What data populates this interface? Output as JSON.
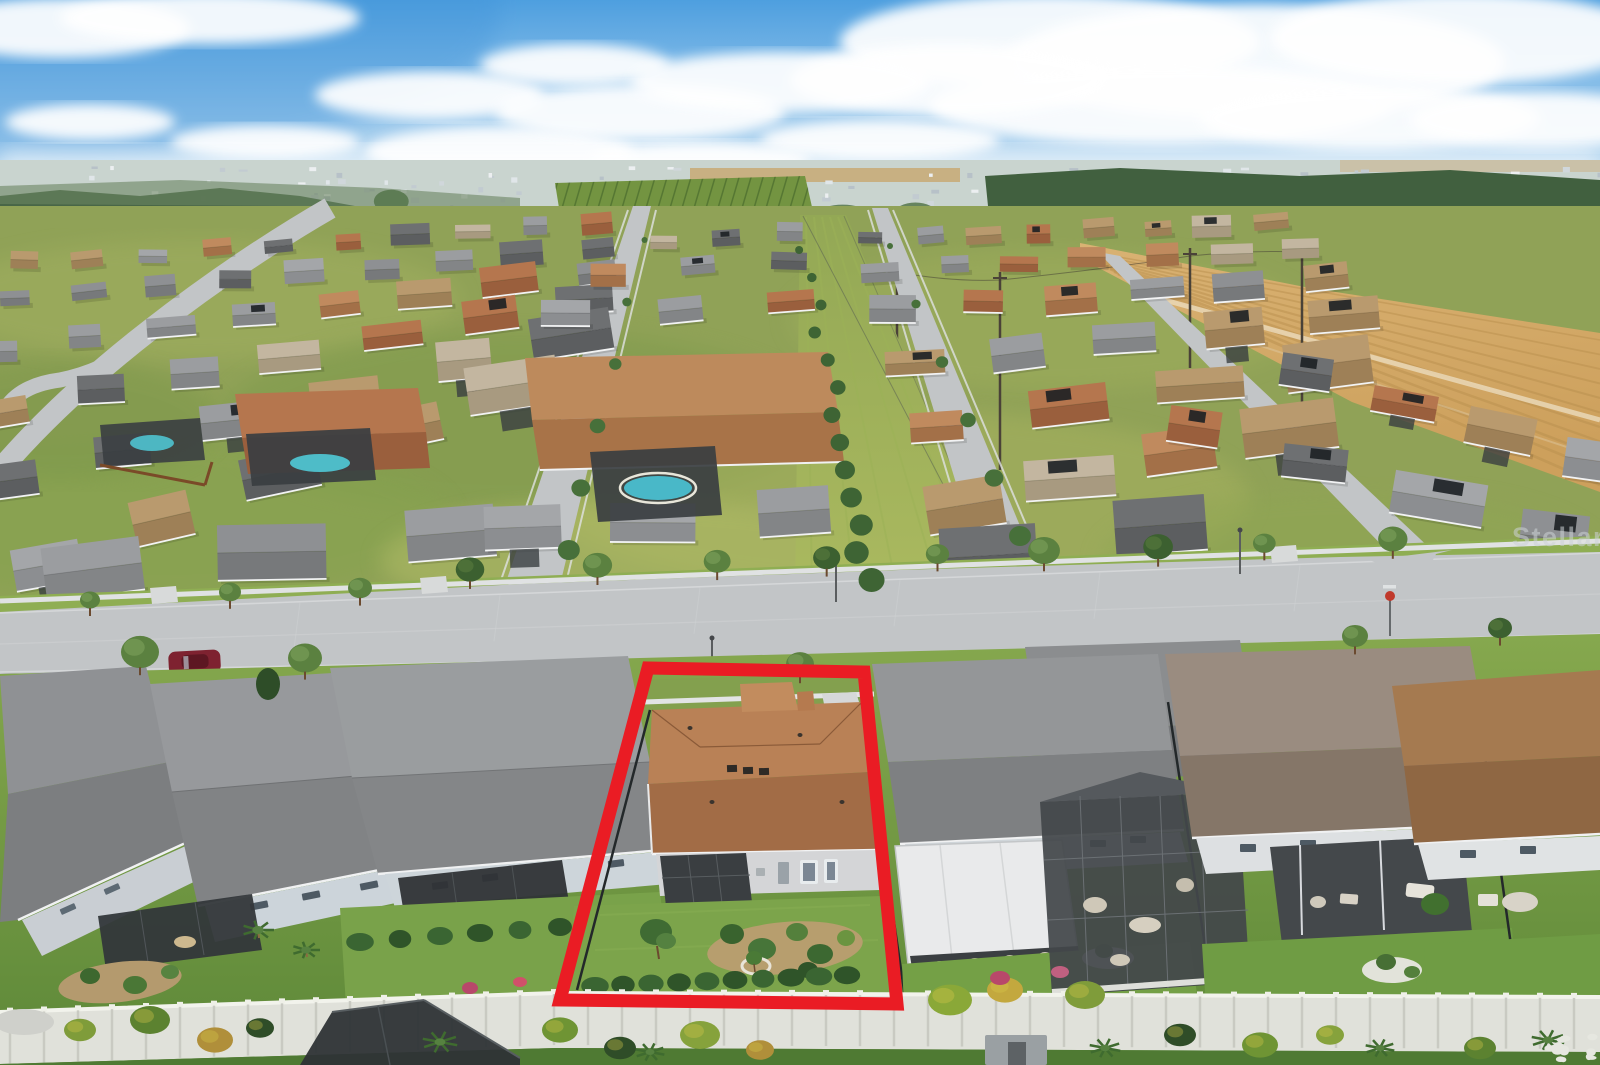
{
  "image": {
    "kind": "aerial-real-estate-photo",
    "description": "Aerial drone view of a suburban single-family neighborhood; subject property outlined in red; lake and plowed field upper right; white privacy wall across foreground",
    "width": 1600,
    "height": 1065
  },
  "watermark": {
    "text": "StellarMLS",
    "color": "#cdd3d6",
    "opacity": 0.55,
    "font_size": 27
  },
  "highlight": {
    "label": "subject-property-outline",
    "color": "#ea1c24",
    "stroke_width": 13,
    "points": [
      [
        648,
        668
      ],
      [
        864,
        672
      ],
      [
        897,
        1004
      ],
      [
        560,
        1000
      ]
    ]
  },
  "palette": {
    "sky_top": "#4e9fdf",
    "sky_mid": "#9cc9ec",
    "sky_horizon": "#e9f2f8",
    "cloud": "#ffffff",
    "haze": "#c9d4cf",
    "far_trees": "#41603f",
    "mid_trees": "#5d7b4a",
    "orchard": "#739441",
    "lake": "#7396ad",
    "lake_deep": "#587f9b",
    "marsh": "#a8906a",
    "field_light": "#d9b273",
    "field_dark": "#b9904f",
    "grass_bright": "#8fae53",
    "grass_yellow": "#aab95f",
    "grass_dark": "#5d8838",
    "street": "#c2c5c7",
    "sidewalk": "#e0e2e3",
    "roof_gray": "#8b8d90",
    "roof_dark": "#6e7072",
    "roof_subject_front": "#b98156",
    "roof_subject_rear": "#a26c46",
    "wall_light": "#d4d5d7",
    "screen_dark": "#3a3e41",
    "fence_white": "#e0e1da",
    "fence_black": "#23282a",
    "pool": "#4fc3d0",
    "car_maroon": "#7e2230"
  }
}
